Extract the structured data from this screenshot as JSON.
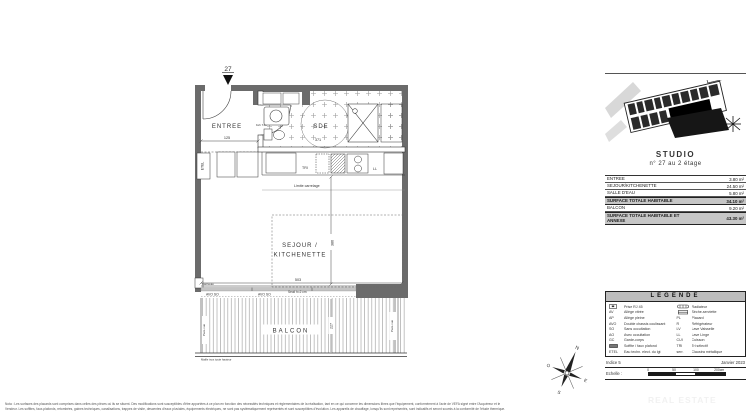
{
  "plan": {
    "unit_arrow_label": "27",
    "entree_label": "ENTREE",
    "entree_dim": "125",
    "sde_label": "SDE",
    "sde_dim": "371",
    "door_note": "bxh 740",
    "etel_label": "ETEL",
    "tri_label": "TRI",
    "ll_label": "LL",
    "limite_carrelage": "Limite carrelage",
    "sejour_line1": "SEJOUR /",
    "sejour_line2": "KITCHENETTE",
    "sejour_width_dim": "503",
    "sejour_height_dim": "386",
    "caniveau_label": "Caniveau",
    "avo_so_left": "AVO SO",
    "avo_so_right": "AVO SO",
    "seuil_label": "Seuil h=2 cm",
    "balcon_label": "BALCON",
    "balcon_dim": "227",
    "pare_vue_left": "Pare-vue",
    "pare_vue_right": "Pare-vue",
    "maille_label": "Maille inox toute hauteur",
    "compass": {
      "n": "N",
      "s": "S",
      "e": "E",
      "o": "O"
    }
  },
  "panel": {
    "title": "STUDIO",
    "subtitle": "n° 27 au 2 étage",
    "areas": [
      {
        "label": "ENTREE",
        "value": "3.80 m²"
      },
      {
        "label": "SEJOUR/KITCHENETTE",
        "value": "24.50 m²"
      },
      {
        "label": "SALLE D'EAU",
        "value": "5.80 m²"
      },
      {
        "label": "SURFACE TOTALE HABITABLE",
        "value": "34.10 m²"
      },
      {
        "label": "BALCON",
        "value": "9.20 m²"
      },
      {
        "label": "SURFACE TOTALE HABITABLE ET ANNEXE",
        "value": "43.30 m²"
      }
    ],
    "legend": {
      "title": "LEGENDE",
      "left": [
        {
          "abbr": "",
          "label": "Prise RJ 45"
        },
        {
          "abbr": "AV",
          "label": "Allège vitrée"
        },
        {
          "abbr": "AP",
          "label": "Allège pleine"
        },
        {
          "abbr": "AVO",
          "label": "Double chassis coulissant"
        },
        {
          "abbr": "SO",
          "label": "Sans occultation"
        },
        {
          "abbr": "AO",
          "label": "Avec occultation"
        },
        {
          "abbr": "GC",
          "label": "Garde-corps"
        },
        {
          "abbr": "",
          "label": "Soffite / faux plafond"
        },
        {
          "abbr": "ETEL",
          "label": "Eau techn. elect. du lgt"
        }
      ],
      "right": [
        {
          "abbr": "",
          "label": "Radiateur"
        },
        {
          "abbr": "",
          "label": "Sèche-serviette"
        },
        {
          "abbr": "PL",
          "label": "Placard"
        },
        {
          "abbr": "R",
          "label": "Réfrigérateur"
        },
        {
          "abbr": "LV",
          "label": "Lave Vaisselle"
        },
        {
          "abbr": "LL",
          "label": "Lave Linge"
        },
        {
          "abbr": "CUI",
          "label": "Cuisson"
        },
        {
          "abbr": "TRI",
          "label": "Tri sélectif"
        },
        {
          "abbr": "serr.",
          "label": "Claustra métallique"
        }
      ]
    },
    "footer": {
      "indice": "Indice 5",
      "date": "Janvier 2023",
      "echelle": "Echelle :",
      "scale_ticks": [
        "0",
        "50",
        "100",
        "200cm"
      ]
    }
  },
  "nota": {
    "line1": "Nota : Les surfaces des placards sont comprises dans celles des pièces où ils se situent. Des modifications sont susceptibles d'être apportées à ce plan en fonction des nécessités techniques et réglementaires de la réalisation, tant en ce qui concerne les dimensions libres que l'équipement, conformément à l'acte de VEFA signé entre l'Acquéreur et le",
    "line2": "Vendeur. Les soffites, faux-plafonds, retombées, gaines techniques, canalisations, trappes de visite, descentes d'eaux pluviales, équipements électriques, ne sont pas systématiquement représentés et sont susceptibles d'évolution. Les appareils de chauffage, lorsqu'ils sont représentés, sont indicatifs et seront soumis à la conformité de l'étude thermique."
  },
  "watermark": "REAL ESTATE"
}
